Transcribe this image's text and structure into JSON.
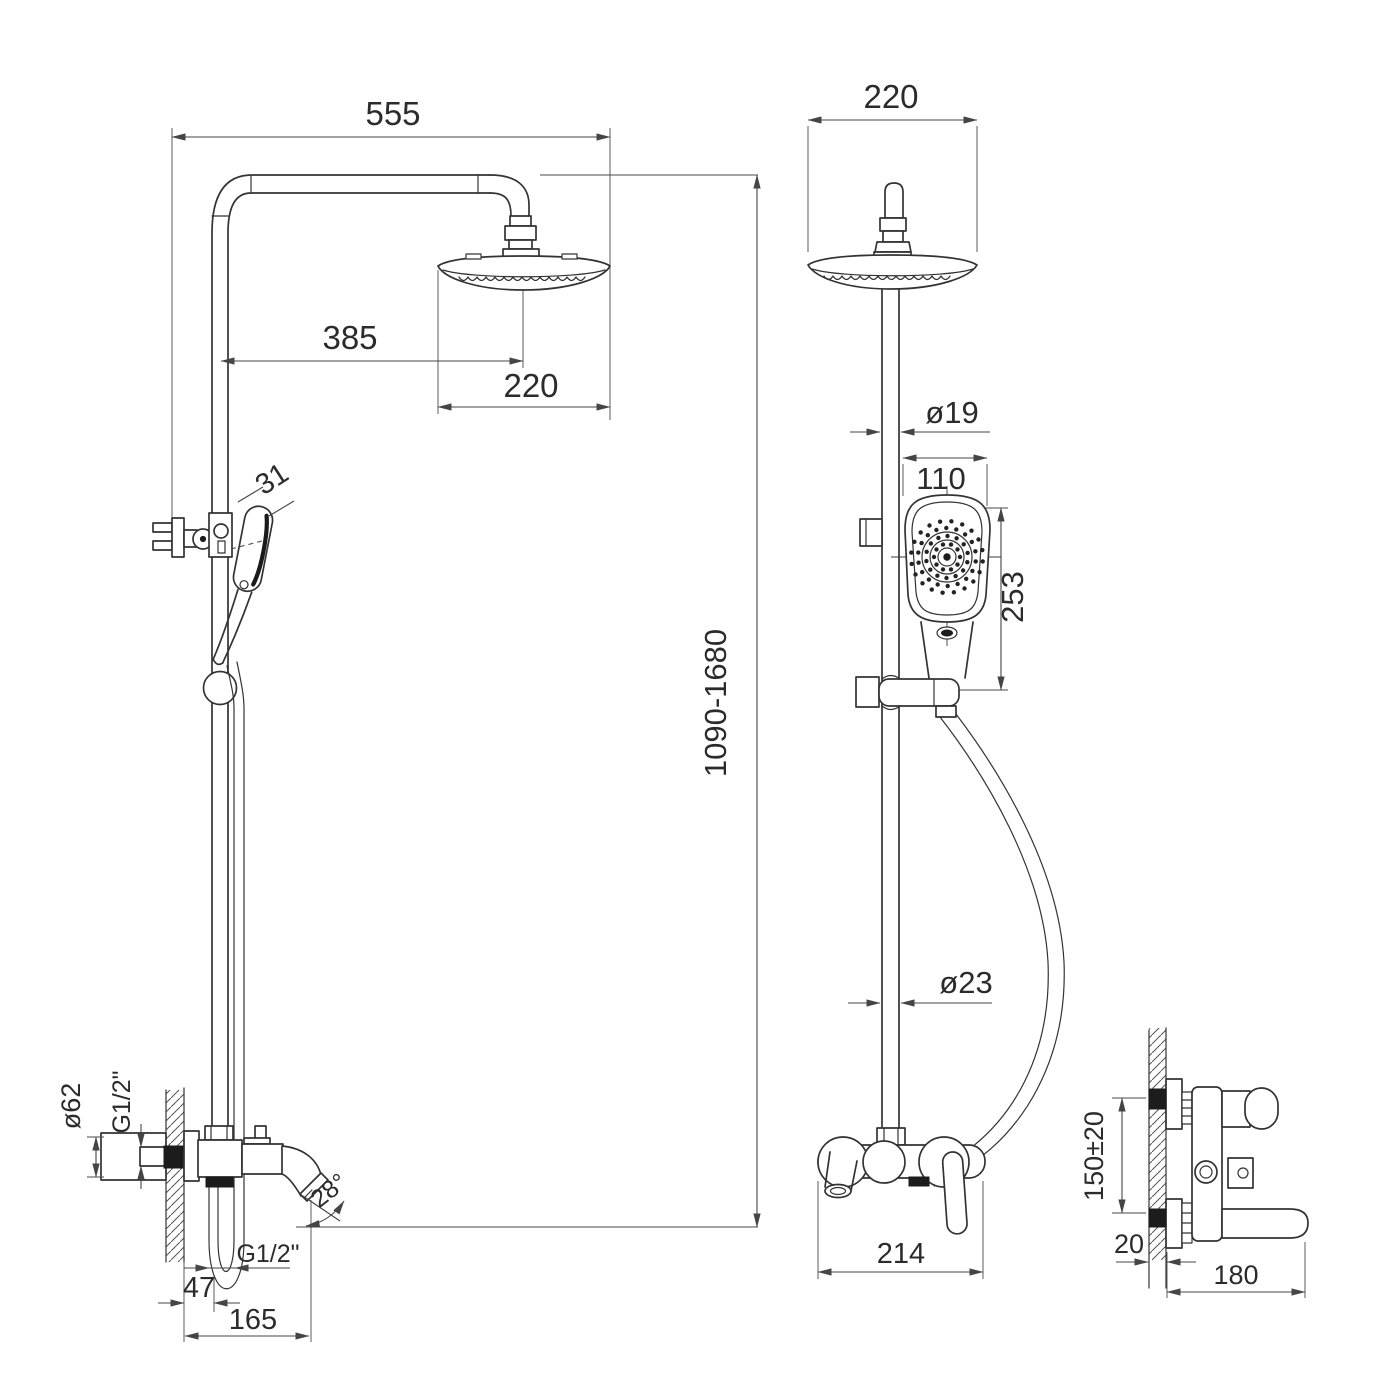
{
  "meta": {
    "type": "technical-dimension-drawing",
    "subject": "Shower column system with rain head, hand shower and wall-mounted bath mixer",
    "units": "mm"
  },
  "front_view": {
    "name": "front-view",
    "dims": {
      "arm_width": "555",
      "head_offset": "385",
      "head_diameter": "220",
      "hand_shower_diameter": "31",
      "column_height": "1090-1680",
      "escutcheon_diameter": "ø62",
      "wall_thread": "G1/2\"",
      "spout_angle": "28°",
      "hose_thread": "G1/2\"",
      "spout_offset": "47",
      "spout_reach": "165"
    }
  },
  "side_view": {
    "name": "side-view",
    "dims": {
      "head_width": "220",
      "rail_diameter": "ø19",
      "hand_shower_width": "110",
      "hand_shower_length": "253",
      "pipe_diameter": "ø23",
      "mixer_width": "214"
    }
  },
  "mixer_side_view": {
    "name": "mixer-side-view",
    "dims": {
      "inlet_spacing": "150±20",
      "wall_thickness": "20",
      "mixer_depth": "180"
    }
  },
  "colors": {
    "line": "#333333",
    "dim_line": "#454545",
    "text": "#2b2b2b",
    "background": "#ffffff"
  }
}
